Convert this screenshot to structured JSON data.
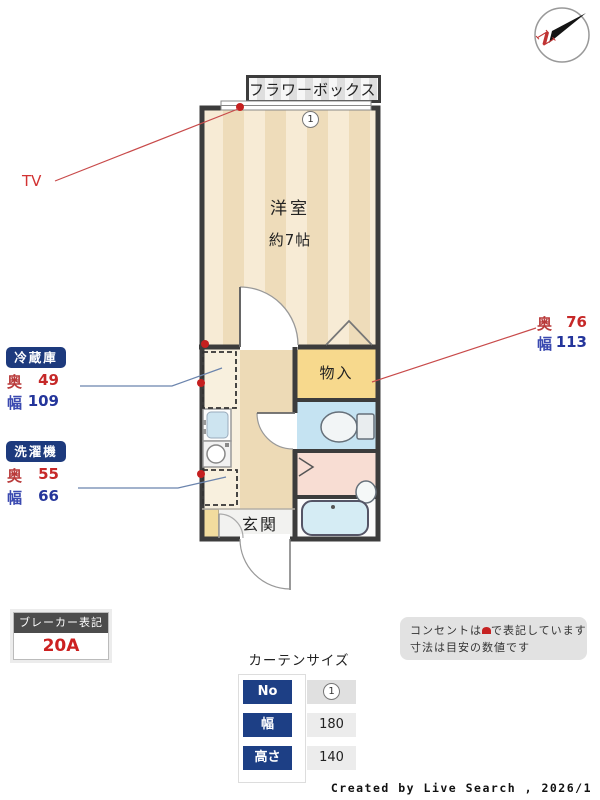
{
  "compass": {
    "north_label": "N"
  },
  "floor_plan": {
    "flower_box_label": "フラワーボックス",
    "window_number": "1",
    "main_room": {
      "name": "洋室",
      "size": "約7帖"
    },
    "closet_label": "物入",
    "entrance_label": "玄関",
    "tv_label": "TV",
    "labels": {
      "depth": "奥",
      "width": "幅"
    },
    "refrigerator": {
      "label": "冷蔵庫",
      "depth": "49",
      "width": "109"
    },
    "washer": {
      "label": "洗濯機",
      "depth": "55",
      "width": "66"
    },
    "closet_dims": {
      "depth": "76",
      "width": "113"
    }
  },
  "breaker": {
    "title": "ブレーカー表記",
    "value": "20A"
  },
  "curtain": {
    "title": "カーテンサイズ",
    "rows": [
      {
        "label": "No",
        "value": "1"
      },
      {
        "label": "幅",
        "value": "180"
      },
      {
        "label": "高さ",
        "value": "140"
      }
    ]
  },
  "notes": {
    "line1_pre": "コンセントは",
    "line1_post": "で表記しています",
    "line2": "寸法は目安の数値です"
  },
  "credit": "Created by Live Search , 2026/1",
  "colors": {
    "accent_red": "#c62828",
    "accent_blue": "#24359b",
    "badge_navy": "#1d3a7d",
    "wall": "#3c3c3c",
    "closet_yellow": "#f7d98d",
    "toilet_blue": "#c5e3f2",
    "washroom_pink": "#f8ddd3"
  }
}
